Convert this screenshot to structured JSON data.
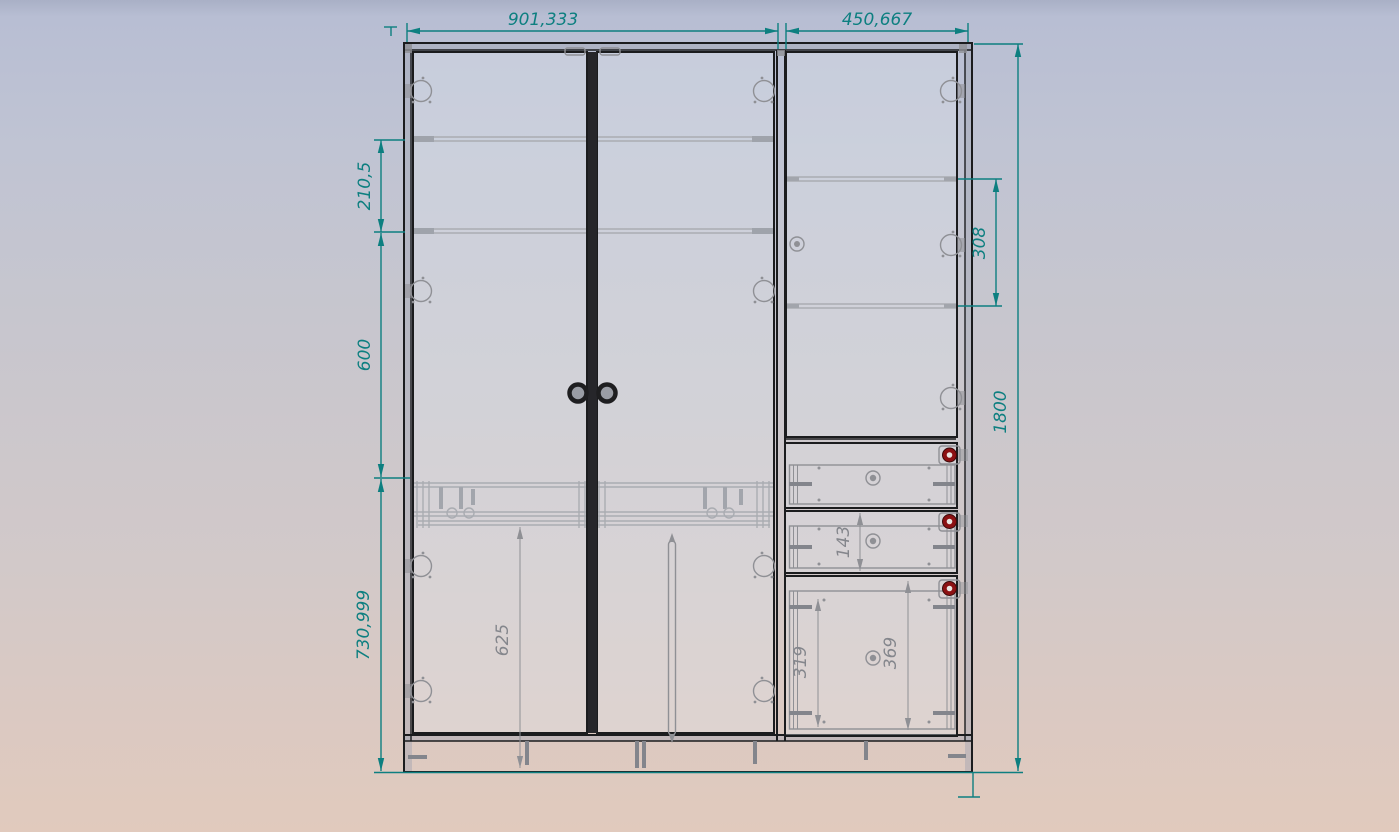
{
  "dims": {
    "left_section_width": "901,333",
    "right_section_width": "450,667",
    "upper_shelf_spacing": "210,5",
    "middle_section_height": "600",
    "lower_section_height": "730,999",
    "right_shelf_spacing": "308",
    "overall_height": "1800",
    "lower_door_height": "625",
    "drawer_front_height": "143",
    "drawer_box_inner_height": "319",
    "drawer_opening_height": "369"
  },
  "colors": {
    "dimension_accent": "#0d7f80",
    "hidden_line_gray": "#8f9095",
    "outline_black": "#1b1c1e",
    "drawer_knob_red": "#8c1113",
    "background_top": "#b7bdd2",
    "background_bottom": "#e1cabd"
  }
}
